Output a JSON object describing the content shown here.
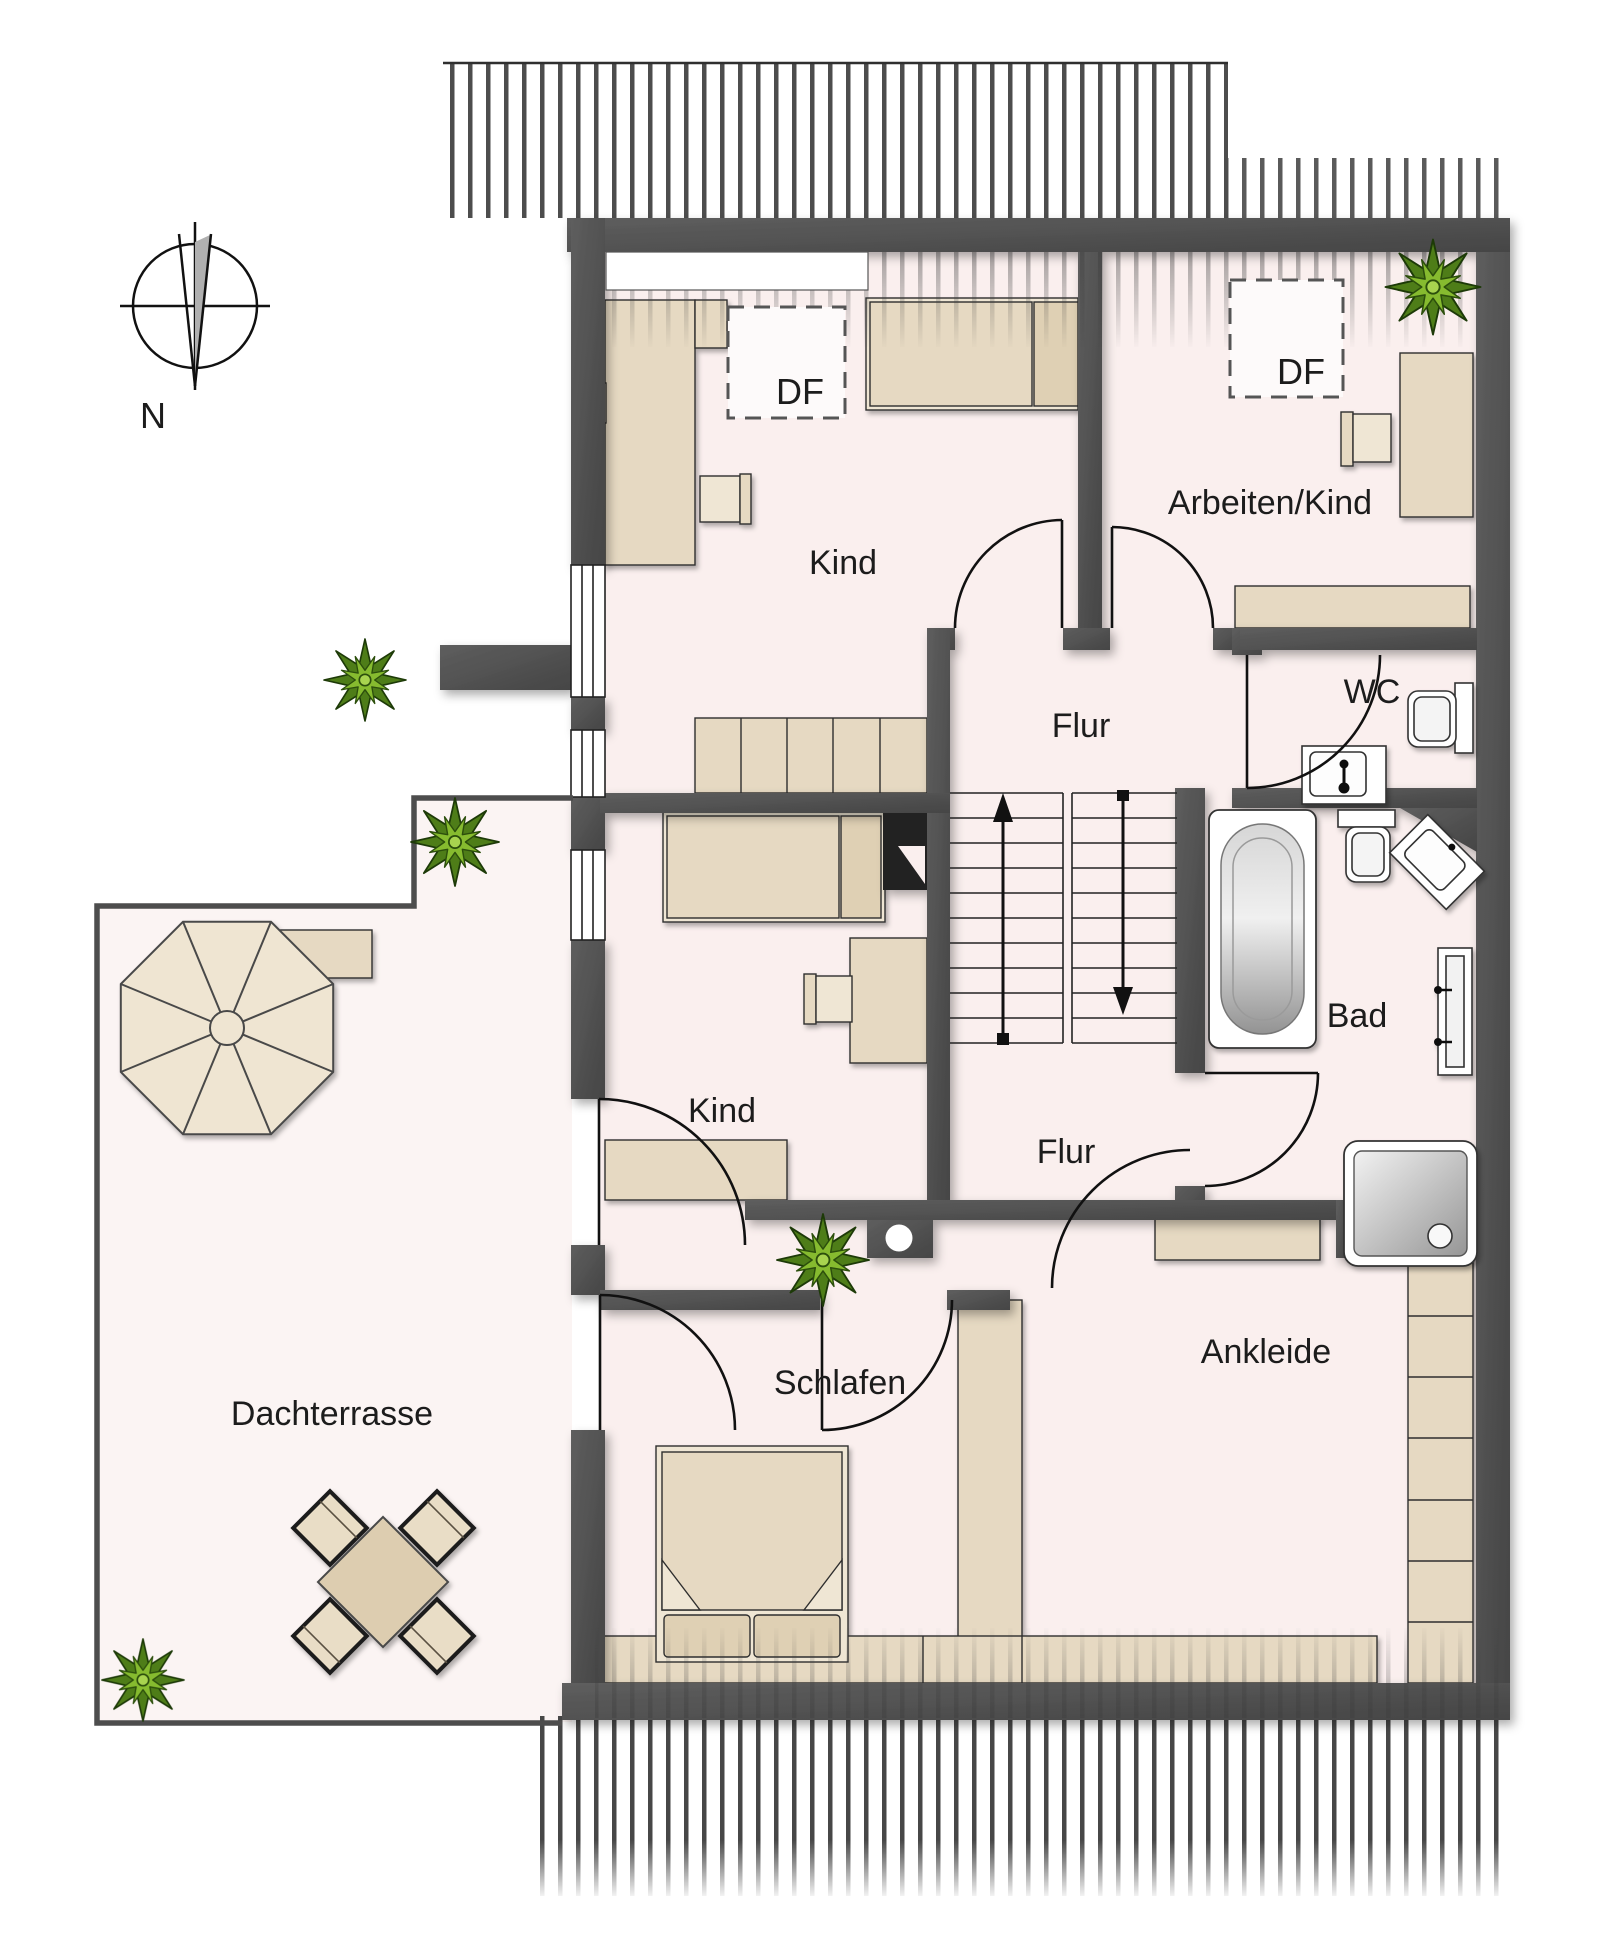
{
  "plan": {
    "type": "floorplan-attic-storey",
    "rooms": [
      {
        "id": "kind-top",
        "label": "Kind"
      },
      {
        "id": "arbeiten-kind",
        "label": "Arbeiten/Kind"
      },
      {
        "id": "flur-upper",
        "label": "Flur"
      },
      {
        "id": "wc",
        "label": "WC"
      },
      {
        "id": "bad",
        "label": "Bad"
      },
      {
        "id": "kind-middle",
        "label": "Kind"
      },
      {
        "id": "flur-lower",
        "label": "Flur"
      },
      {
        "id": "schlafen",
        "label": "Schlafen"
      },
      {
        "id": "ankleide",
        "label": "Ankleide"
      },
      {
        "id": "dachterrasse",
        "label": "Dachterrasse"
      }
    ],
    "roof_windows": [
      {
        "id": "df-1",
        "label": "DF"
      },
      {
        "id": "df-2",
        "label": "DF"
      }
    ],
    "compass": {
      "label": "N"
    },
    "colors": {
      "wall": "#4d4d4d",
      "floor": "#faefee",
      "terrace_floor": "#fbf4f3",
      "furniture_beige": "#e6d9c2",
      "furniture_light": "#efe6d4",
      "furniture_dark": "#dfd0b4",
      "plant_green_outer": "#4e7d18",
      "plant_green_inner": "#86bb2f",
      "line": "#111111",
      "hatch": "#3d3d3d"
    },
    "features": [
      "compass-rose-icon",
      "roof-overhang-hatch-top",
      "roof-overhang-hatch-bottom",
      "roof-window-dashed-box",
      "wardrobe",
      "bed-single",
      "bed-double",
      "desk",
      "chair",
      "sideboard",
      "stairs-up-arrow",
      "stairs-down-arrow",
      "toilet",
      "washbasin",
      "corner-washbasin",
      "bathtub",
      "shower",
      "towel-radiator",
      "door-swing-arc",
      "window",
      "plant-icon",
      "parasol-octagon",
      "terrace-table-set",
      "chimney-circle"
    ]
  }
}
